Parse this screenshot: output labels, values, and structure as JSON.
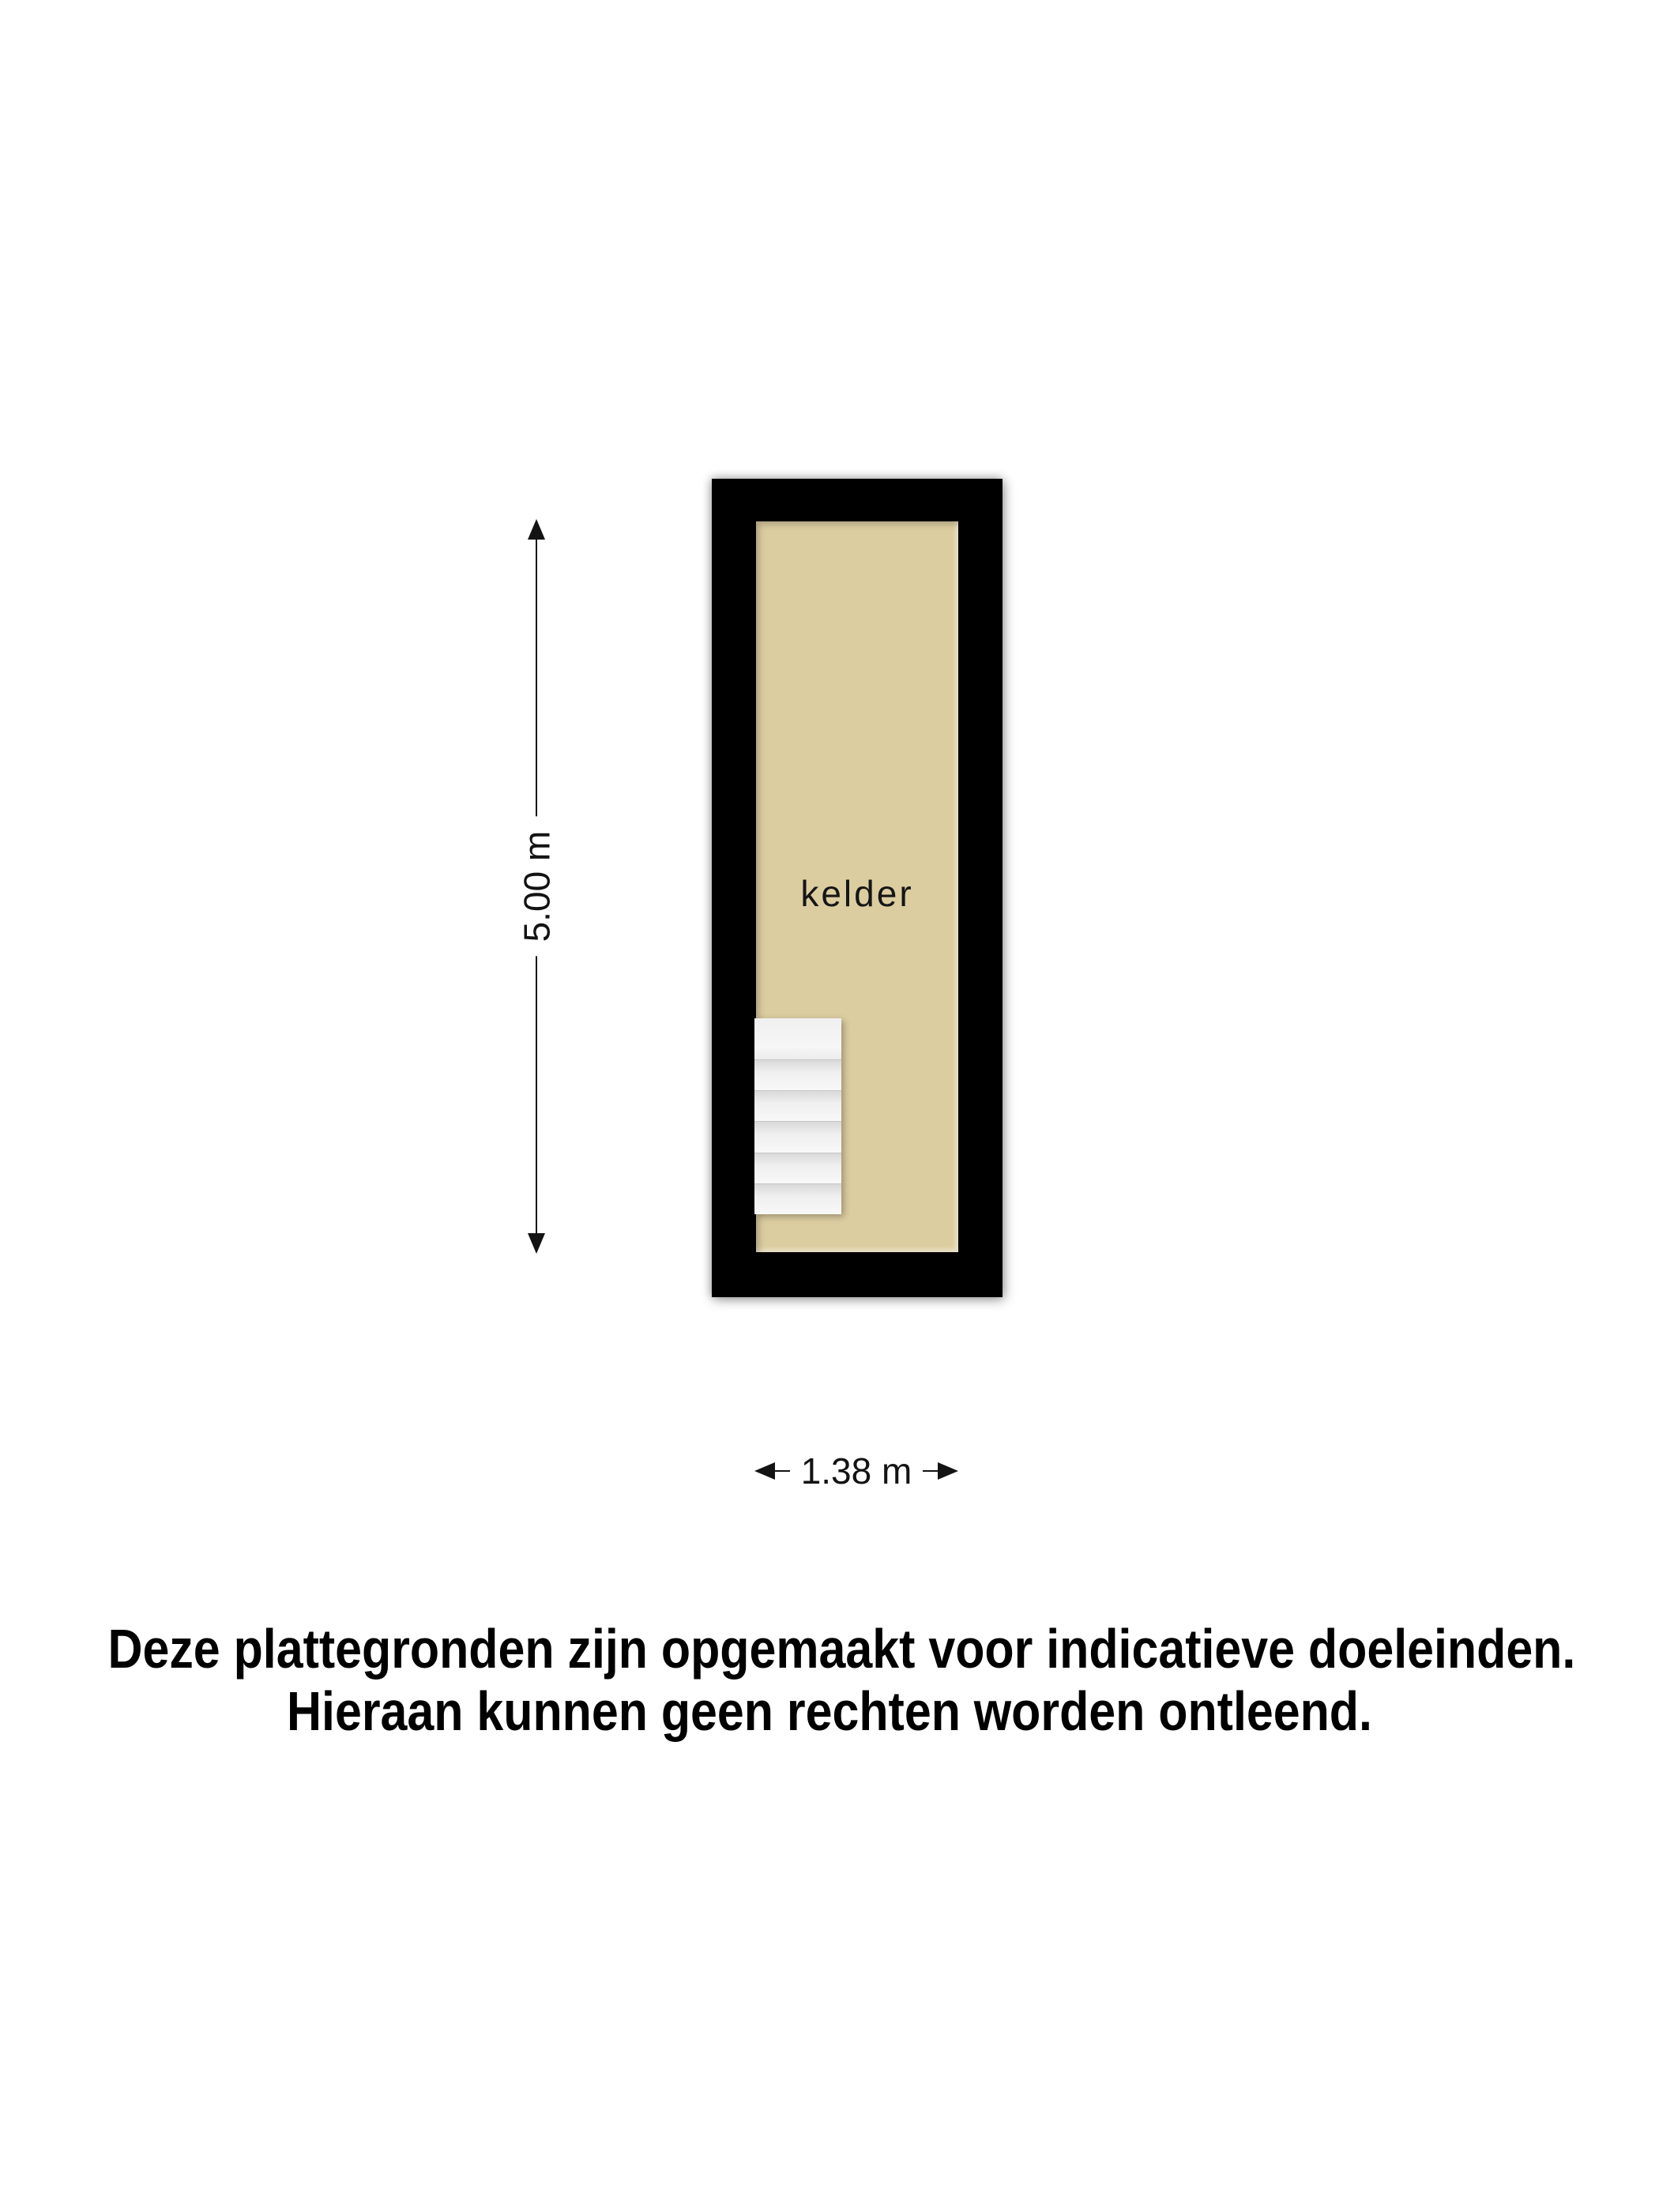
{
  "colors": {
    "wall": "#000000",
    "floor": "#dccda0",
    "dim": "#131313",
    "text": "#000000",
    "stair": "#f2f2f2"
  },
  "floorplan": {
    "room": {
      "label": "kelder"
    },
    "stairs": {
      "treads": 6
    }
  },
  "dimensions": {
    "vertical": {
      "label": "5.00 m"
    },
    "horizontal": {
      "label": "1.38 m"
    }
  },
  "disclaimer": {
    "line1": "Deze plattegronden zijn opgemaakt voor indicatieve doeleinden.",
    "line2": "Hieraan kunnen geen rechten worden ontleend."
  }
}
